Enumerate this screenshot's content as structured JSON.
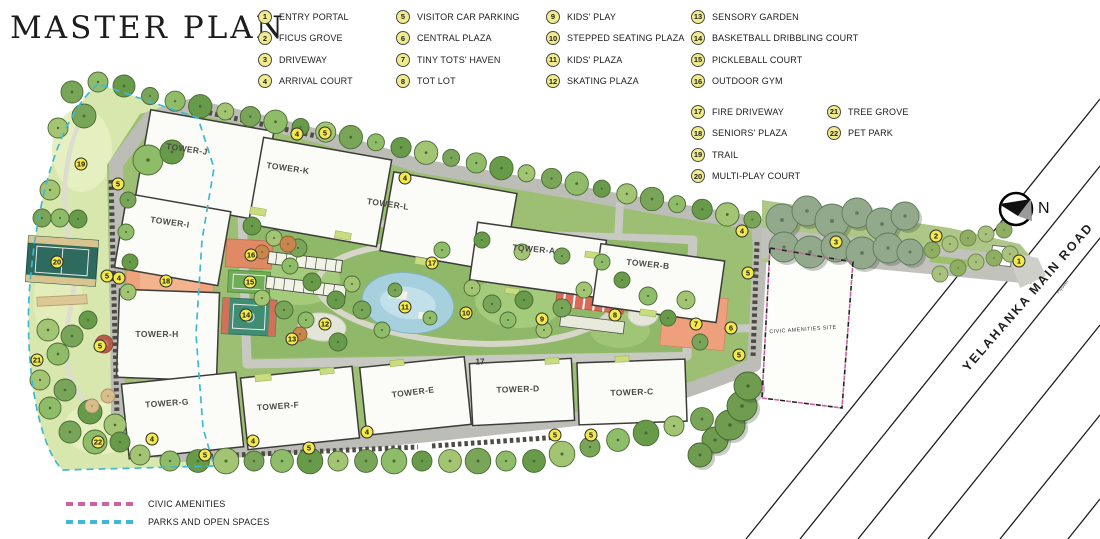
{
  "title": "MASTER PLAN",
  "legend": {
    "columns": [
      {
        "x": 258,
        "y": 6,
        "items": [
          {
            "num": "1",
            "label": "ENTRY PORTAL"
          },
          {
            "num": "2",
            "label": "FICUS GROVE"
          },
          {
            "num": "3",
            "label": "DRIVEWAY"
          },
          {
            "num": "4",
            "label": "ARRIVAL COURT"
          }
        ]
      },
      {
        "x": 396,
        "y": 6,
        "items": [
          {
            "num": "5",
            "label": "VISITOR CAR PARKING"
          },
          {
            "num": "6",
            "label": "CENTRAL PLAZA"
          },
          {
            "num": "7",
            "label": "TINY TOTS' HAVEN"
          },
          {
            "num": "8",
            "label": "TOT LOT"
          }
        ]
      },
      {
        "x": 546,
        "y": 6,
        "items": [
          {
            "num": "9",
            "label": "KIDS' PLAY"
          },
          {
            "num": "10",
            "label": "STEPPED SEATING PLAZA"
          },
          {
            "num": "11",
            "label": "KIDS' PLAZA"
          },
          {
            "num": "12",
            "label": "SKATING PLAZA"
          }
        ]
      },
      {
        "x": 691,
        "y": 6,
        "items": [
          {
            "num": "13",
            "label": "SENSORY GARDEN"
          },
          {
            "num": "14",
            "label": "BASKETBALL DRIBBLING COURT"
          },
          {
            "num": "15",
            "label": "PICKLEBALL COURT"
          },
          {
            "num": "16",
            "label": "OUTDOOR GYM"
          }
        ]
      },
      {
        "x": 691,
        "y": 101,
        "items": [
          {
            "num": "17",
            "label": "FIRE DRIVEWAY"
          },
          {
            "num": "18",
            "label": "SENIORS' PLAZA"
          },
          {
            "num": "19",
            "label": "TRAIL"
          },
          {
            "num": "20",
            "label": "MULTI-PLAY COURT"
          }
        ]
      },
      {
        "x": 827,
        "y": 101,
        "items": [
          {
            "num": "21",
            "label": "TREE GROVE"
          },
          {
            "num": "22",
            "label": "PET PARK"
          }
        ]
      }
    ]
  },
  "map": {
    "road_label": "YELAHANKA MAIN ROAD",
    "flyover_label": "Flyover",
    "civic_site_label": "CIVIC AMENITIES SITE",
    "north_label": "N",
    "fire_lane_label": "17",
    "badges": [
      {
        "n": "1",
        "x": 1019,
        "y": 261
      },
      {
        "n": "2",
        "x": 936,
        "y": 236
      },
      {
        "n": "3",
        "x": 836,
        "y": 242
      },
      {
        "n": "4",
        "x": 297,
        "y": 134
      },
      {
        "n": "4",
        "x": 405,
        "y": 178
      },
      {
        "n": "4",
        "x": 742,
        "y": 231
      },
      {
        "n": "4",
        "x": 119,
        "y": 278
      },
      {
        "n": "4",
        "x": 152,
        "y": 439
      },
      {
        "n": "4",
        "x": 253,
        "y": 441
      },
      {
        "n": "4",
        "x": 367,
        "y": 432
      },
      {
        "n": "5",
        "x": 325,
        "y": 133
      },
      {
        "n": "5",
        "x": 748,
        "y": 273
      },
      {
        "n": "5",
        "x": 739,
        "y": 355
      },
      {
        "n": "5",
        "x": 118,
        "y": 184
      },
      {
        "n": "5",
        "x": 107,
        "y": 276
      },
      {
        "n": "5",
        "x": 100,
        "y": 346
      },
      {
        "n": "5",
        "x": 205,
        "y": 455
      },
      {
        "n": "5",
        "x": 309,
        "y": 448
      },
      {
        "n": "5",
        "x": 555,
        "y": 435
      },
      {
        "n": "5",
        "x": 591,
        "y": 435
      },
      {
        "n": "6",
        "x": 731,
        "y": 328
      },
      {
        "n": "7",
        "x": 696,
        "y": 324
      },
      {
        "n": "8",
        "x": 615,
        "y": 315
      },
      {
        "n": "9",
        "x": 542,
        "y": 319
      },
      {
        "n": "10",
        "x": 466,
        "y": 313
      },
      {
        "n": "11",
        "x": 405,
        "y": 307
      },
      {
        "n": "12",
        "x": 325,
        "y": 324
      },
      {
        "n": "13",
        "x": 292,
        "y": 339
      },
      {
        "n": "14",
        "x": 246,
        "y": 315
      },
      {
        "n": "15",
        "x": 250,
        "y": 282
      },
      {
        "n": "16",
        "x": 251,
        "y": 255
      },
      {
        "n": "17",
        "x": 432,
        "y": 263
      },
      {
        "n": "18",
        "x": 166,
        "y": 281
      },
      {
        "n": "19",
        "x": 81,
        "y": 164
      },
      {
        "n": "20",
        "x": 57,
        "y": 262
      },
      {
        "n": "21",
        "x": 37,
        "y": 360
      },
      {
        "n": "22",
        "x": 98,
        "y": 442
      }
    ],
    "towers": [
      {
        "label": "TOWER-J",
        "x": 187,
        "y": 149,
        "rot": 8
      },
      {
        "label": "TOWER-K",
        "x": 288,
        "y": 168,
        "rot": 8
      },
      {
        "label": "TOWER-L",
        "x": 388,
        "y": 204,
        "rot": 8
      },
      {
        "label": "TOWER-I",
        "x": 170,
        "y": 222,
        "rot": 8
      },
      {
        "label": "TOWER-A",
        "x": 534,
        "y": 249,
        "rot": 5
      },
      {
        "label": "TOWER-B",
        "x": 648,
        "y": 264,
        "rot": 6
      },
      {
        "label": "TOWER-H",
        "x": 157,
        "y": 334,
        "rot": 0
      },
      {
        "label": "TOWER-G",
        "x": 167,
        "y": 403,
        "rot": -4
      },
      {
        "label": "TOWER-F",
        "x": 278,
        "y": 406,
        "rot": -4
      },
      {
        "label": "TOWER-E",
        "x": 413,
        "y": 392,
        "rot": -7
      },
      {
        "label": "TOWER-D",
        "x": 518,
        "y": 389,
        "rot": -2
      },
      {
        "label": "TOWER-C",
        "x": 632,
        "y": 392,
        "rot": -2
      }
    ]
  },
  "footer_legend": {
    "items": [
      {
        "label": "CIVIC AMENITIES",
        "color": "#cf5fa6",
        "x": 66,
        "y": 498
      },
      {
        "label": "PARKS AND OPEN SPACES",
        "color": "#3eb9d4",
        "x": 66,
        "y": 516
      }
    ]
  },
  "colors": {
    "badge_yellow": "#f3e94d",
    "legend_yellow": "#f0ec8e",
    "civic_boundary": "#cf5fa6",
    "parks_boundary": "#3eb9d4",
    "plaza_orange": "#efa37d",
    "pond_blue": "#a7d0de",
    "court_teal": "#3f8d72",
    "road_gray": "#bdbdb8"
  }
}
